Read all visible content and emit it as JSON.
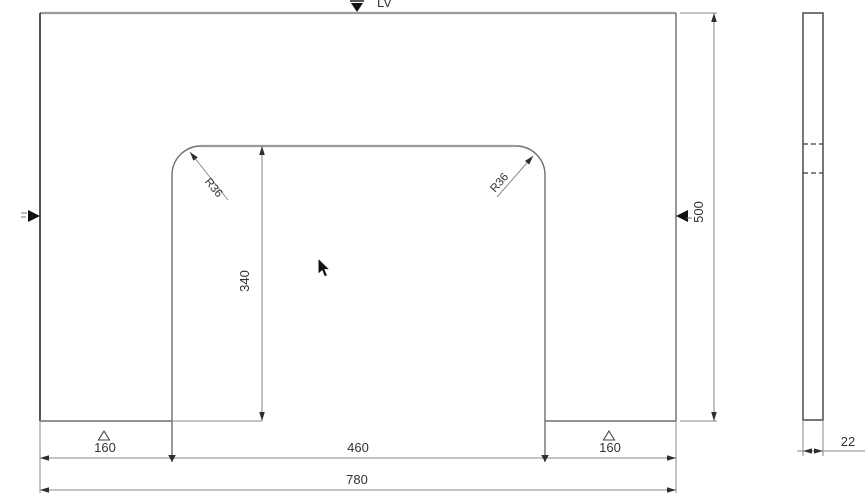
{
  "top_marker": {
    "label": "LV"
  },
  "main_view": {
    "dim_bottom_left": "160",
    "dim_bottom_center": "460",
    "dim_bottom_right": "160",
    "dim_total_width": "780",
    "dim_height": "500",
    "dim_notch_height": "340",
    "dim_radius_left": "R36",
    "dim_radius_right": "R36"
  },
  "side_view": {
    "dim_thickness": "22"
  },
  "colors": {
    "background": "#ffffff",
    "outline": "#6f6f6f",
    "dimension_line": "#8a8a8a",
    "text": "#333333",
    "datum_marker": "#111111",
    "top_label": "#20293a"
  }
}
